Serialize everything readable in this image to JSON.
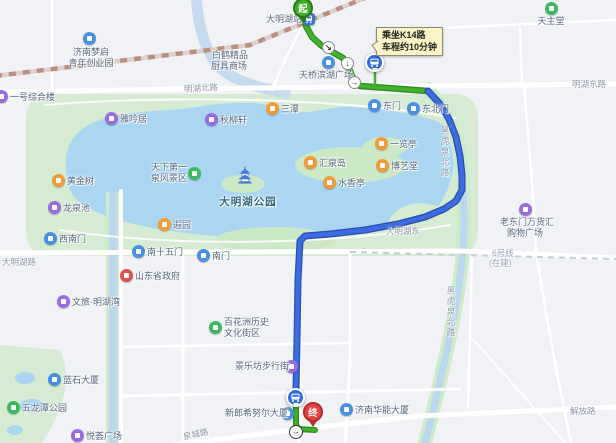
{
  "transit_tip": {
    "line1": "乘坐K14路",
    "line2": "车程约10分钟"
  },
  "route": {
    "start_label": "起",
    "end_label": "终",
    "arrows": [
      "↘",
      "↓",
      "→",
      "→"
    ],
    "walk_color": "#41b12c",
    "transit_color": "#3d6be0"
  },
  "pois": [
    {
      "label": "大明湖站",
      "icon": "metro-station-icon",
      "color": "#3b74d6"
    },
    {
      "lines": [
        "济南梦启",
        "青年创业园"
      ],
      "icon": "enterprise-park-icon",
      "color": "#4a90e2"
    },
    {
      "lines": [
        "白鹤精品",
        "厨具商场"
      ],
      "icon": "none",
      "color": ""
    },
    {
      "label": "天主堂",
      "icon": "church-icon",
      "color": "#3dba5e"
    },
    {
      "label": "一号综合楼",
      "icon": "building-icon",
      "color": "#9b6ce0"
    },
    {
      "label": "天桥滨湖广场",
      "icon": "plaza-icon",
      "color": "#4a90e2"
    },
    {
      "label": "东门",
      "icon": "gate-icon",
      "color": "#4a90e2"
    },
    {
      "label": "东北门",
      "icon": "gate-icon",
      "color": "#4a90e2"
    },
    {
      "label": "雅吟居",
      "icon": "heritage-icon",
      "color": "#9b6ce0"
    },
    {
      "label": "秋柳轩",
      "icon": "heritage-icon",
      "color": "#9b6ce0"
    },
    {
      "label": "三潭",
      "icon": "scenic-icon",
      "color": "#f09a38"
    },
    {
      "lines": [
        "天下第一",
        "泉风景区"
      ],
      "icon": "scenic-area-icon",
      "color": "#3dba5e"
    },
    {
      "label": "汇泉岛",
      "icon": "scenic-icon",
      "color": "#f09a38"
    },
    {
      "label": "一览亭",
      "icon": "scenic-icon",
      "color": "#f09a38"
    },
    {
      "label": "博艺堂",
      "icon": "scenic-icon",
      "color": "#f09a38"
    },
    {
      "label": "水香亭",
      "icon": "scenic-icon",
      "color": "#f09a38"
    },
    {
      "label": "黄金树",
      "icon": "scenic-icon",
      "color": "#f09a38"
    },
    {
      "label": "龙泉池",
      "icon": "heritage-icon",
      "color": "#9b6ce0"
    },
    {
      "label": "大明湖公园",
      "icon": "pagoda-icon",
      "color": "#4b7bd0"
    },
    {
      "label": "遐园",
      "icon": "scenic-icon",
      "color": "#f09a38"
    },
    {
      "label": "西南门",
      "icon": "gate-icon",
      "color": "#4a90e2"
    },
    {
      "label": "南十五门",
      "icon": "gate-icon",
      "color": "#4a90e2"
    },
    {
      "label": "南门",
      "icon": "gate-icon",
      "color": "#4a90e2"
    },
    {
      "label": "山东省政府",
      "icon": "government-icon",
      "color": "#e05252"
    },
    {
      "label": "文旅·明湖湾",
      "icon": "culture-icon",
      "color": "#9b6ce0"
    },
    {
      "lines": [
        "百花洲历史",
        "文化街区"
      ],
      "icon": "historic-district-icon",
      "color": "#3dba5e"
    },
    {
      "label": "景乐坊步行街",
      "icon": "shopping-street-icon",
      "color": "#9b6ce0"
    },
    {
      "label": "新郎希努尔大厦",
      "icon": "building-icon",
      "color": "#4a90e2"
    },
    {
      "label": "济南华能大厦",
      "icon": "building-icon",
      "color": "#4a90e2"
    },
    {
      "label": "蓝石大厦",
      "icon": "building-icon",
      "color": "#4a90e2"
    },
    {
      "label": "五龙潭公园",
      "icon": "park-icon",
      "color": "#3dba5e"
    },
    {
      "label": "悦荟广场",
      "icon": "mall-icon",
      "color": "#9b6ce0"
    },
    {
      "lines": [
        "老东门万货汇",
        "购物广场"
      ],
      "icon": "mall-icon",
      "color": "#9b6ce0"
    }
  ],
  "road_labels": [
    {
      "label": "明湖北路"
    },
    {
      "label": "明湖东路"
    },
    {
      "label": "大明湖东"
    },
    {
      "label": "大明湖路"
    },
    {
      "label": "6号线"
    },
    {
      "label": "(在建)"
    },
    {
      "label": "黑虎泉北路"
    },
    {
      "label": "泉城路"
    },
    {
      "label": "解放路"
    }
  ],
  "colors": {
    "land": "#f0f2f6",
    "park": "#d6ecd2",
    "water": "#abd6f1",
    "road": "#ffffff",
    "railway": "#bd8e7e",
    "tooltip_bg": "#fbf4c6",
    "start": "#3fae27",
    "end": "#e64340"
  }
}
